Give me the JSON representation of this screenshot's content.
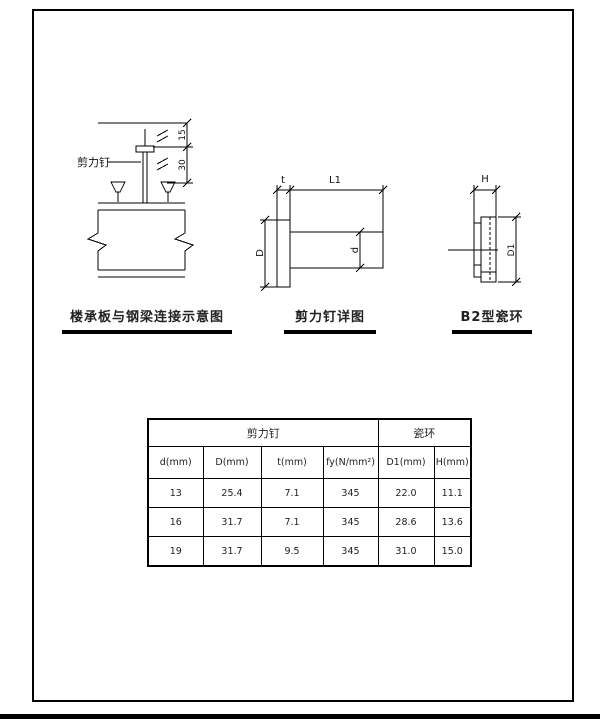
{
  "diagrams": {
    "deck_connection": {
      "title": "楼承板与钢梁连接示意图",
      "stud_label": "剪力钉",
      "dim_upper": "15",
      "dim_lower": "30"
    },
    "stud_detail": {
      "title": "剪力钉详图",
      "dim_t": "t",
      "dim_L1": "L1",
      "dim_D": "D",
      "dim_d": "d"
    },
    "ceramic_ring": {
      "title": "B2型瓷环",
      "dim_H": "H",
      "dim_D1": "D1"
    }
  },
  "table": {
    "groups": [
      {
        "label": "剪力钉"
      },
      {
        "label": "瓷环"
      }
    ],
    "columns": [
      "d(mm)",
      "D(mm)",
      "t(mm)",
      "fy(N/mm²)",
      "D1(mm)",
      "H(mm)"
    ],
    "rows": [
      [
        "13",
        "25.4",
        "7.1",
        "345",
        "22.0",
        "11.1"
      ],
      [
        "16",
        "31.7",
        "7.1",
        "345",
        "28.6",
        "13.6"
      ],
      [
        "19",
        "31.7",
        "9.5",
        "345",
        "31.0",
        "15.0"
      ]
    ]
  }
}
